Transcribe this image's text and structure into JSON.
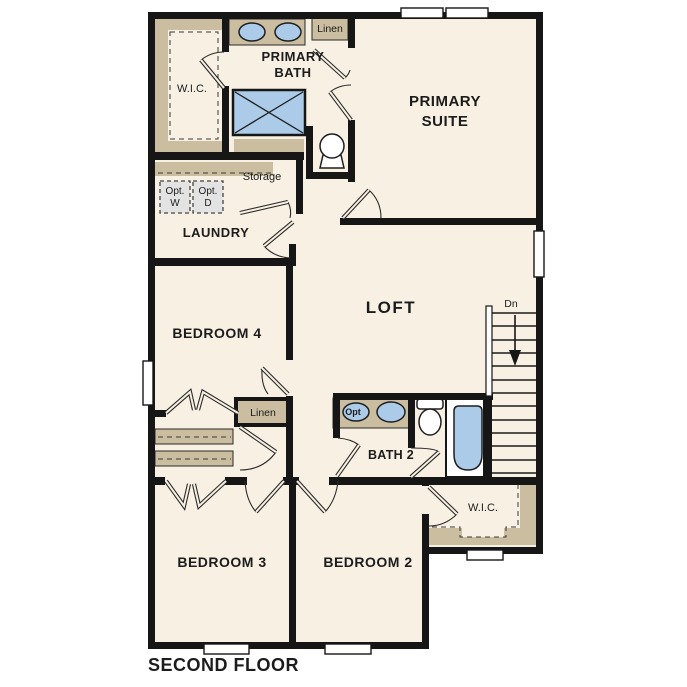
{
  "plan_title": "SECOND FLOOR",
  "colors": {
    "background": "#ffffff",
    "wall": "#161616",
    "floor": "#f7f0e3",
    "casework_tan": "#cbbda0",
    "fixture_blue": "#abcbe9",
    "optional_appliance_gray": "#e3e3e3"
  },
  "rooms": {
    "primary_bath": {
      "line1": "PRIMARY",
      "line2": "BATH"
    },
    "primary_wic": {
      "label": "W.I.C."
    },
    "bath_linen": {
      "label": "Linen"
    },
    "primary_suite": {
      "line1": "PRIMARY",
      "line2": "SUITE"
    },
    "storage": {
      "label": "Storage"
    },
    "laundry": {
      "label": "LAUNDRY"
    },
    "bedroom4": {
      "label": "BEDROOM 4"
    },
    "loft": {
      "label": "LOFT"
    },
    "hall_linen": {
      "label": "Linen"
    },
    "bath2": {
      "label": "BATH 2"
    },
    "bedroom2_wic": {
      "label": "W.I.C."
    },
    "bedroom3": {
      "label": "BEDROOM 3"
    },
    "bedroom2": {
      "label": "BEDROOM 2"
    }
  },
  "appliances": {
    "washer": {
      "line1": "Opt.",
      "line2": "W"
    },
    "dryer": {
      "line1": "Opt.",
      "line2": "D"
    }
  },
  "stairs": {
    "direction_label": "Dn"
  },
  "fixtures": {
    "bath2_optional_sink_label": "Opt"
  }
}
